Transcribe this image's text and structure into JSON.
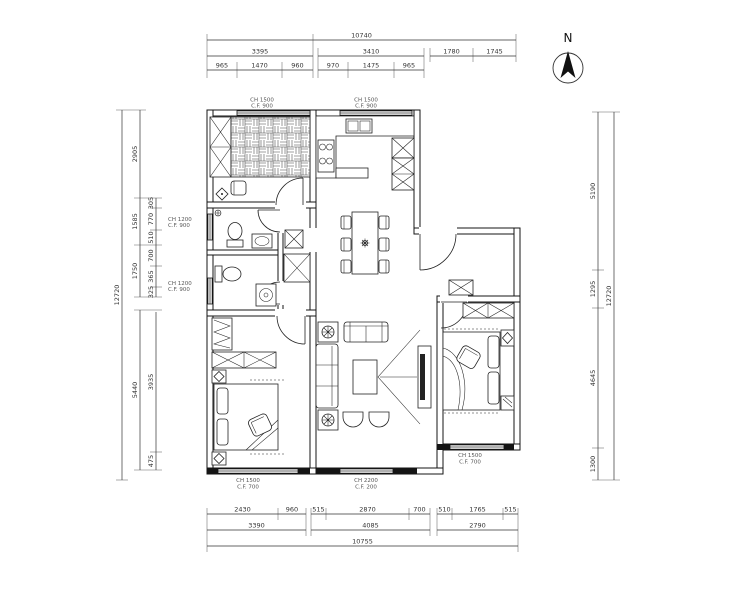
{
  "north": {
    "label": "N"
  },
  "dims": {
    "top": {
      "overall": "10740",
      "row2": [
        "3395",
        "3410",
        "1780",
        "1745"
      ],
      "row3": [
        "965",
        "1470",
        "960",
        "970",
        "1475",
        "965"
      ]
    },
    "bottom": {
      "row1": [
        "2430",
        "960",
        "515",
        "2870",
        "700",
        "510",
        "1765",
        "515"
      ],
      "row2": [
        "3390",
        "4085",
        "2790"
      ],
      "overall": "10755"
    },
    "left": {
      "overall": "12720",
      "outer": [
        "2905",
        "1585",
        "1750",
        "5440"
      ],
      "inner": [
        "305",
        "770",
        "510",
        "700",
        "365",
        "325",
        "3935",
        "475"
      ]
    },
    "right": {
      "overall": "12720",
      "inner": [
        "5190",
        "1295",
        "4645",
        "1300"
      ]
    }
  },
  "window_labels": [
    {
      "l1": "CH 1500",
      "l2": "C.F. 900"
    },
    {
      "l1": "CH 1500",
      "l2": "C.F. 900"
    },
    {
      "l1": "CH 1200",
      "l2": "C.F. 900"
    },
    {
      "l1": "CH 1200",
      "l2": "C.F. 900"
    },
    {
      "l1": "CH 1500",
      "l2": "C.F. 700"
    },
    {
      "l1": "CH 2200",
      "l2": "C.F. 200"
    },
    {
      "l1": "CH 1500",
      "l2": "C.F. 700"
    }
  ]
}
